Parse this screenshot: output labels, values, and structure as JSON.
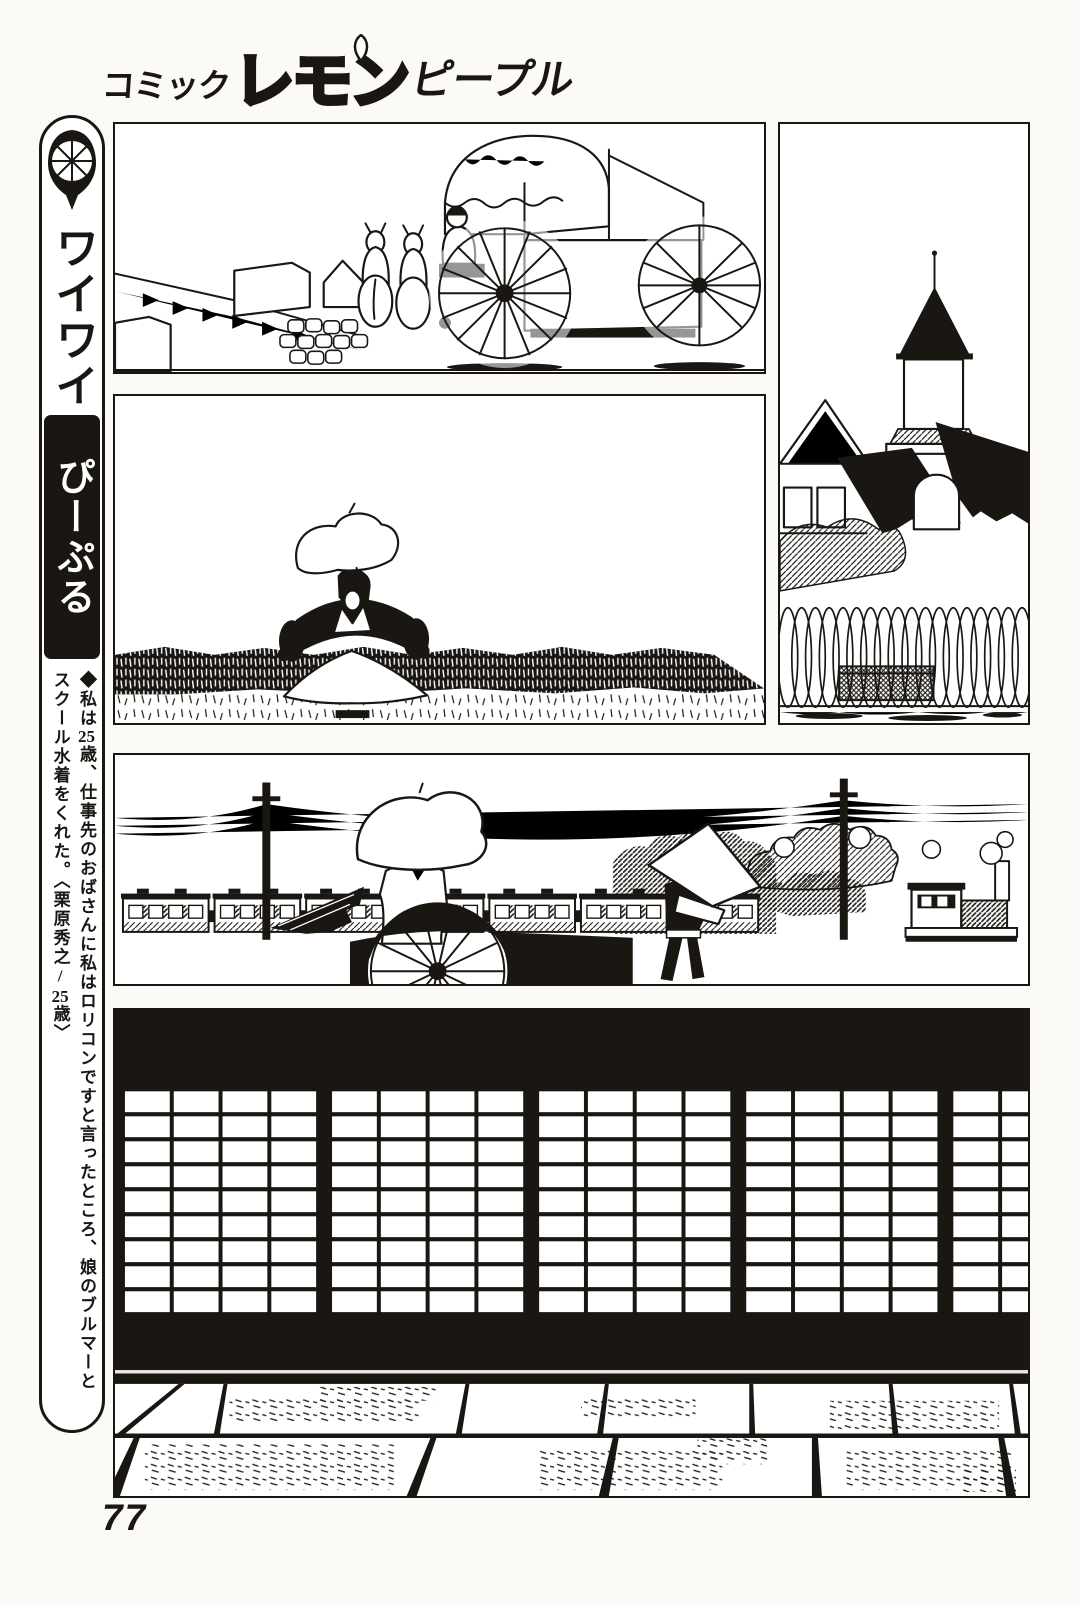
{
  "page": {
    "number": "77",
    "ink": "#1a1713",
    "paper": "#ffffff"
  },
  "masthead": {
    "prefix": "コミック",
    "main": "レモン",
    "suffix": "ピープル",
    "leaf_icon": "lemon-leaf-icon"
  },
  "sidebar": {
    "lemon_icon": "lemon-slice-icon",
    "series_top": "ワイワイ",
    "series_bottom": "ぴーぷる",
    "caption_parts": {
      "p1": "◆私は",
      "n1": "25",
      "p2": "歳、仕事先のおばさんに私はロリコンですと言ったところ、娘のブルマーとスクール水着をくれた。〈栗原秀之/",
      "n2": "25",
      "p3": "歳〉"
    }
  },
  "panels": [
    {
      "id": "panel-1",
      "alt": "Horse-drawn covered carriage with large spoked wheels passing stone buildings in a village street"
    },
    {
      "id": "panel-2",
      "alt": "Woman with a white parasol seated in a rickshaw in a wide grassy field"
    },
    {
      "id": "panel-3",
      "alt": "Western-style building with a pointed tower and dark roofs behind a looped iron fence"
    },
    {
      "id": "panel-4",
      "alt": "Steam locomotive and passenger cars passing behind a rickshaw pulled by a man in a conical hat"
    },
    {
      "id": "panel-5",
      "alt": "Dark interior silhouette of shoji lattice screens above a tatami mat floor"
    }
  ]
}
